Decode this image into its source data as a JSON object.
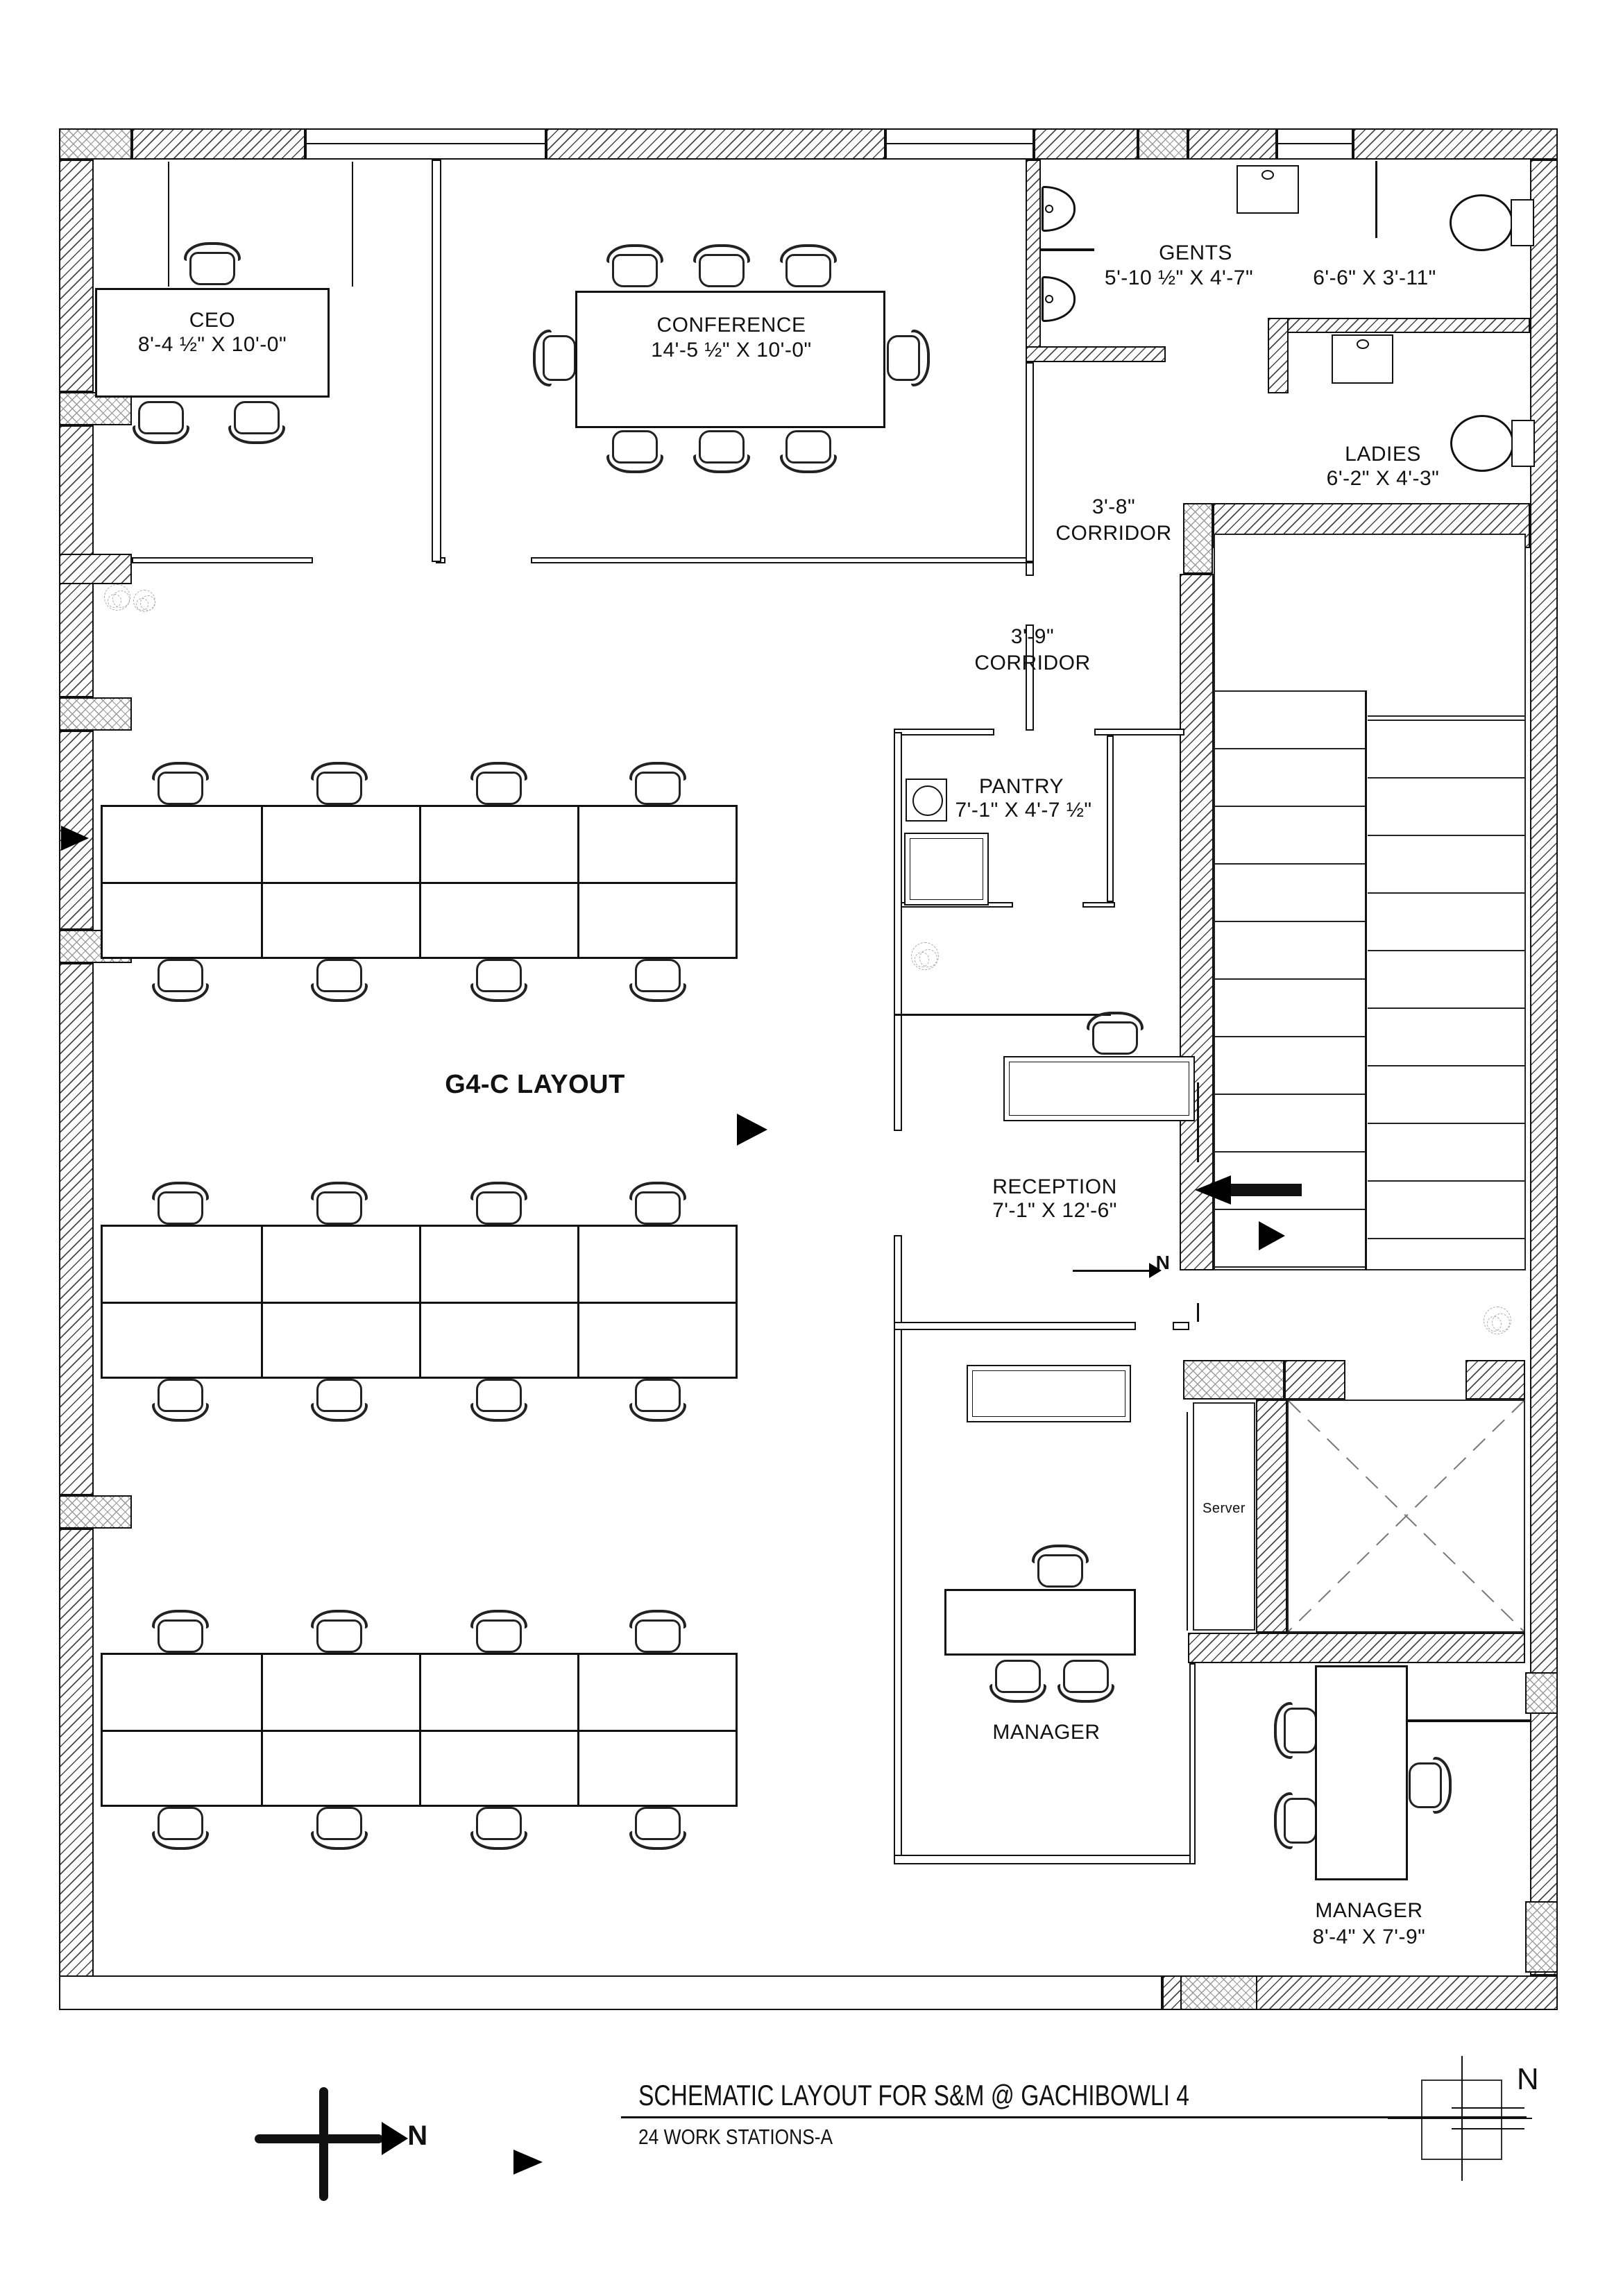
{
  "title_block": {
    "title": "SCHEMATIC LAYOUT FOR S&M @ GACHIBOWLI 4",
    "subtitle": "24 WORK STATIONS-A"
  },
  "plan_label": "G4-C LAYOUT",
  "compass_north": "N",
  "reception_north": "N",
  "north_symbol": "N",
  "rooms": {
    "ceo": {
      "name": "CEO",
      "dims": "8'-4 ½\" X 10'-0\""
    },
    "conference": {
      "name": "CONFERENCE",
      "dims": "14'-5 ½\" X 10'-0\""
    },
    "gents": {
      "name": "GENTS",
      "dims": "5'-10 ½\" X 4'-7\""
    },
    "gents_wash": {
      "dims": "6'-6\" X 3'-11\""
    },
    "ladies": {
      "name": "LADIES",
      "dims": "6'-2\" X 4'-3\""
    },
    "corridor_38": {
      "width": "3'-8\"",
      "label": "CORRIDOR"
    },
    "corridor_39": {
      "width": "3'-9\"",
      "label": "CORRIDOR"
    },
    "pantry": {
      "name": "PANTRY",
      "dims": "7'-1\" X 4'-7 ½\""
    },
    "reception": {
      "name": "RECEPTION",
      "dims": "7'-1\" X 12'-6\""
    },
    "server": {
      "name": "Server"
    },
    "manager1": {
      "name": "MANAGER"
    },
    "manager2": {
      "name": "MANAGER",
      "dims": "8'-4\" X 7'-9\""
    }
  }
}
